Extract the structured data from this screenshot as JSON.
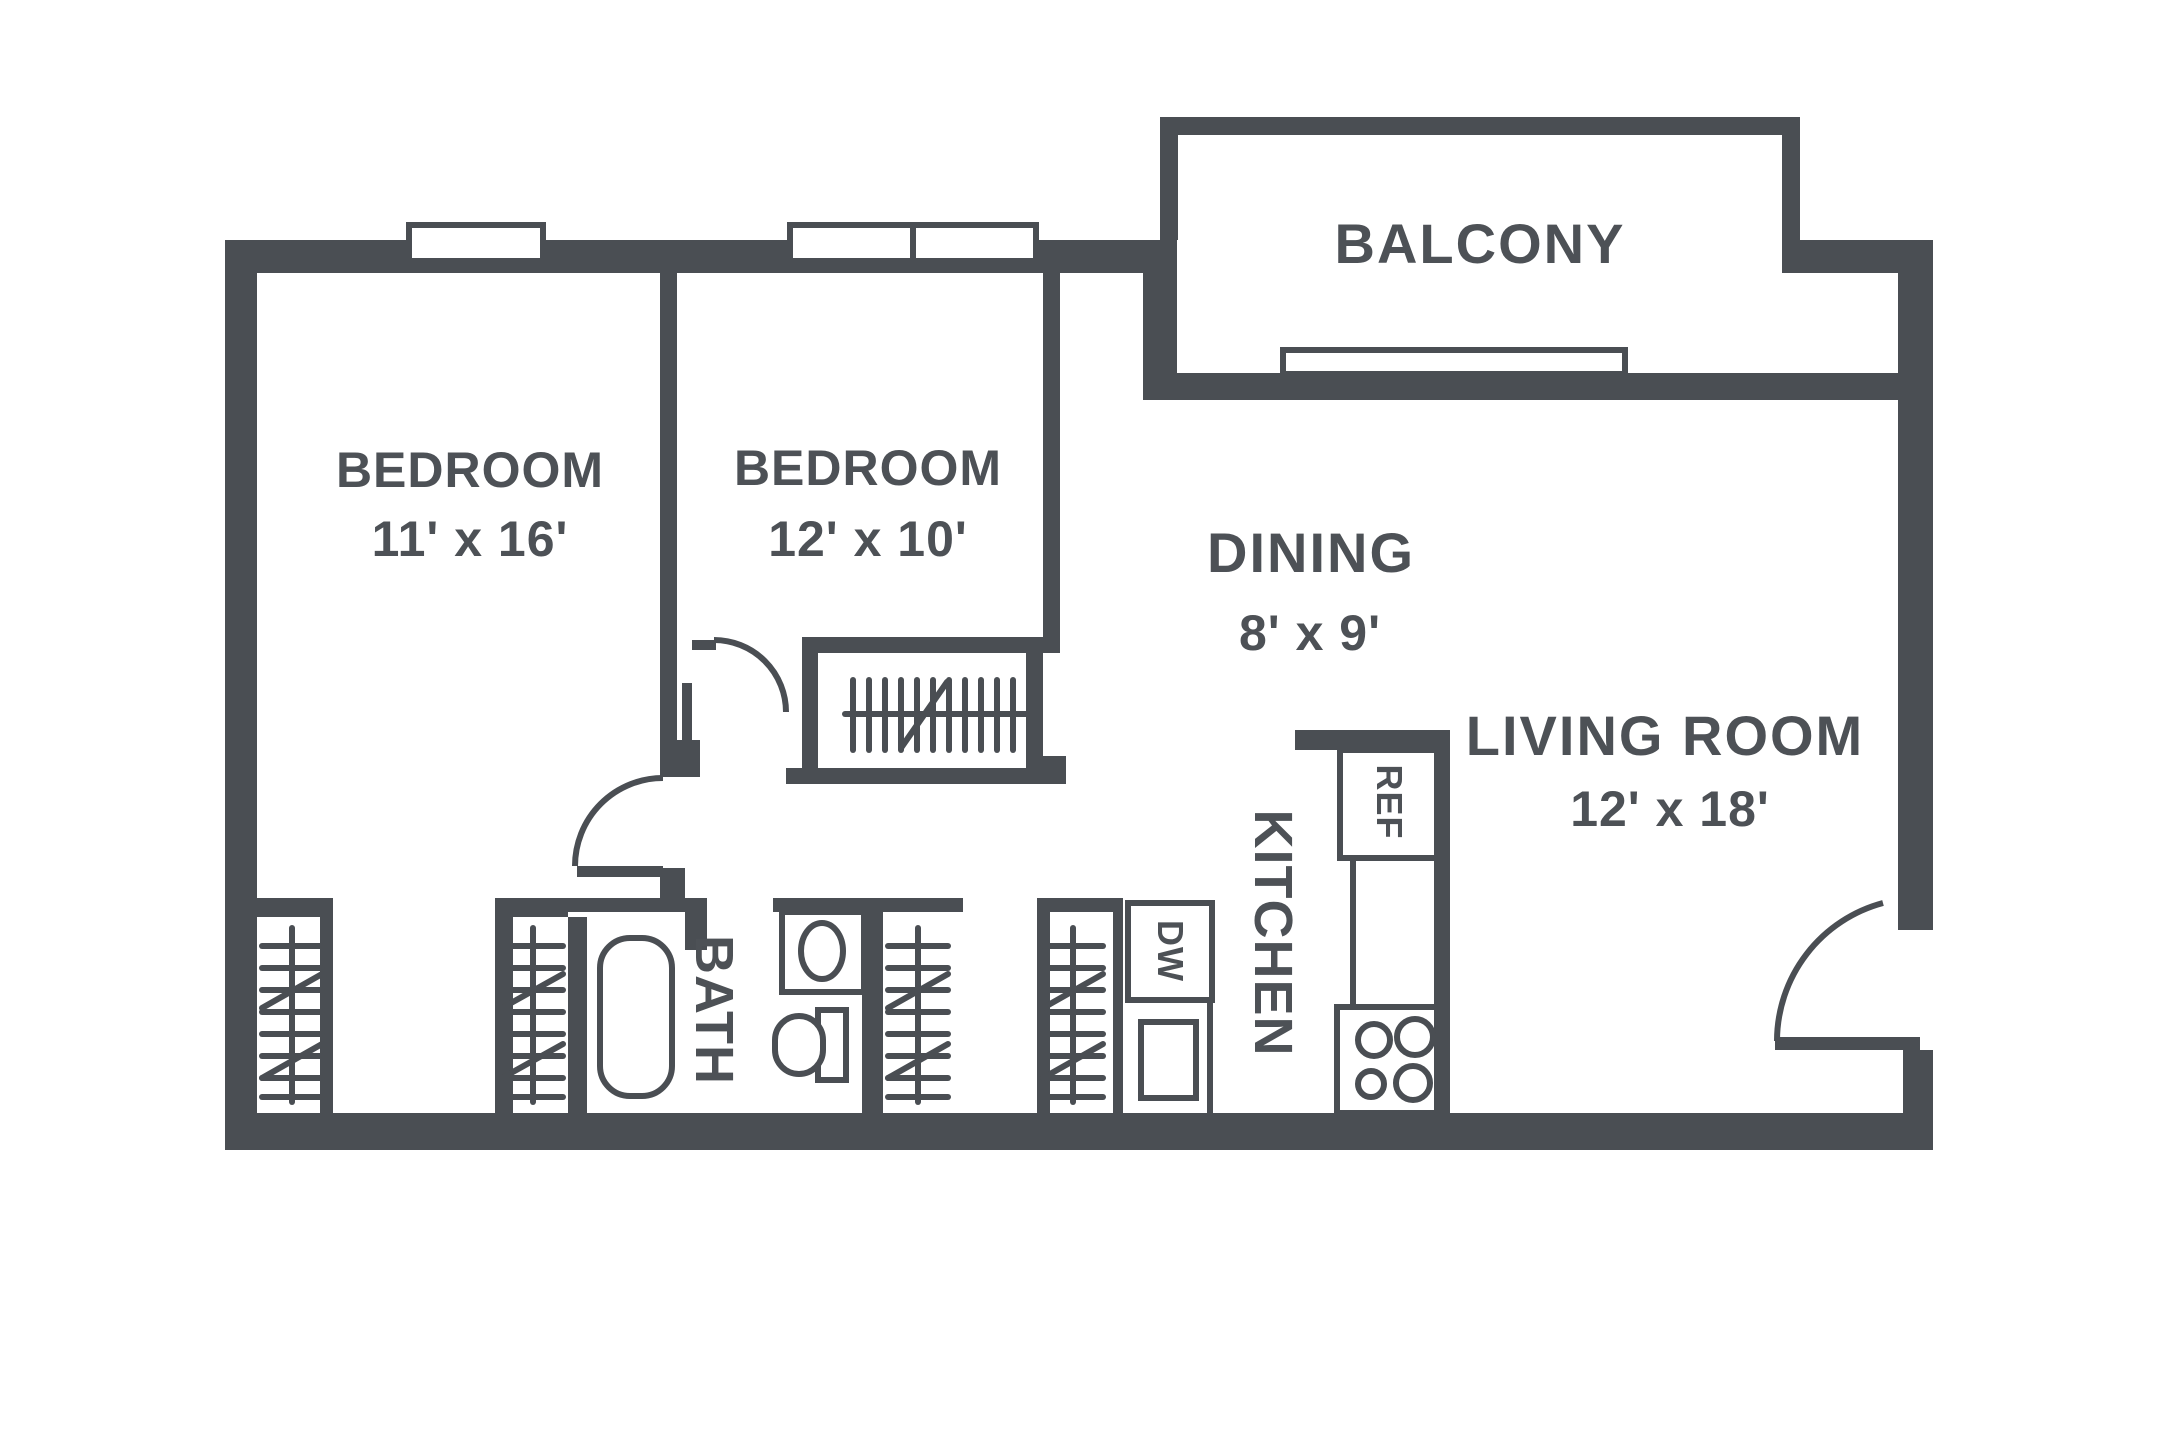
{
  "colors": {
    "wall": "#4a4e53",
    "text": "#4d5156",
    "bg": "#ffffff"
  },
  "rooms": {
    "balcony": {
      "label": "BALCONY"
    },
    "bedroom1": {
      "label": "BEDROOM",
      "dims": "11' x 16'"
    },
    "bedroom2": {
      "label": "BEDROOM",
      "dims": "12' x 10'"
    },
    "dining": {
      "label": "DINING",
      "dims": "8' x 9'"
    },
    "living": {
      "label": "LIVING ROOM",
      "dims": "12' x 18'"
    },
    "kitchen": {
      "label": "KITCHEN"
    },
    "bath": {
      "label": "BATH"
    }
  },
  "appliances": {
    "refrigerator": "REF",
    "dishwasher": "DW"
  }
}
